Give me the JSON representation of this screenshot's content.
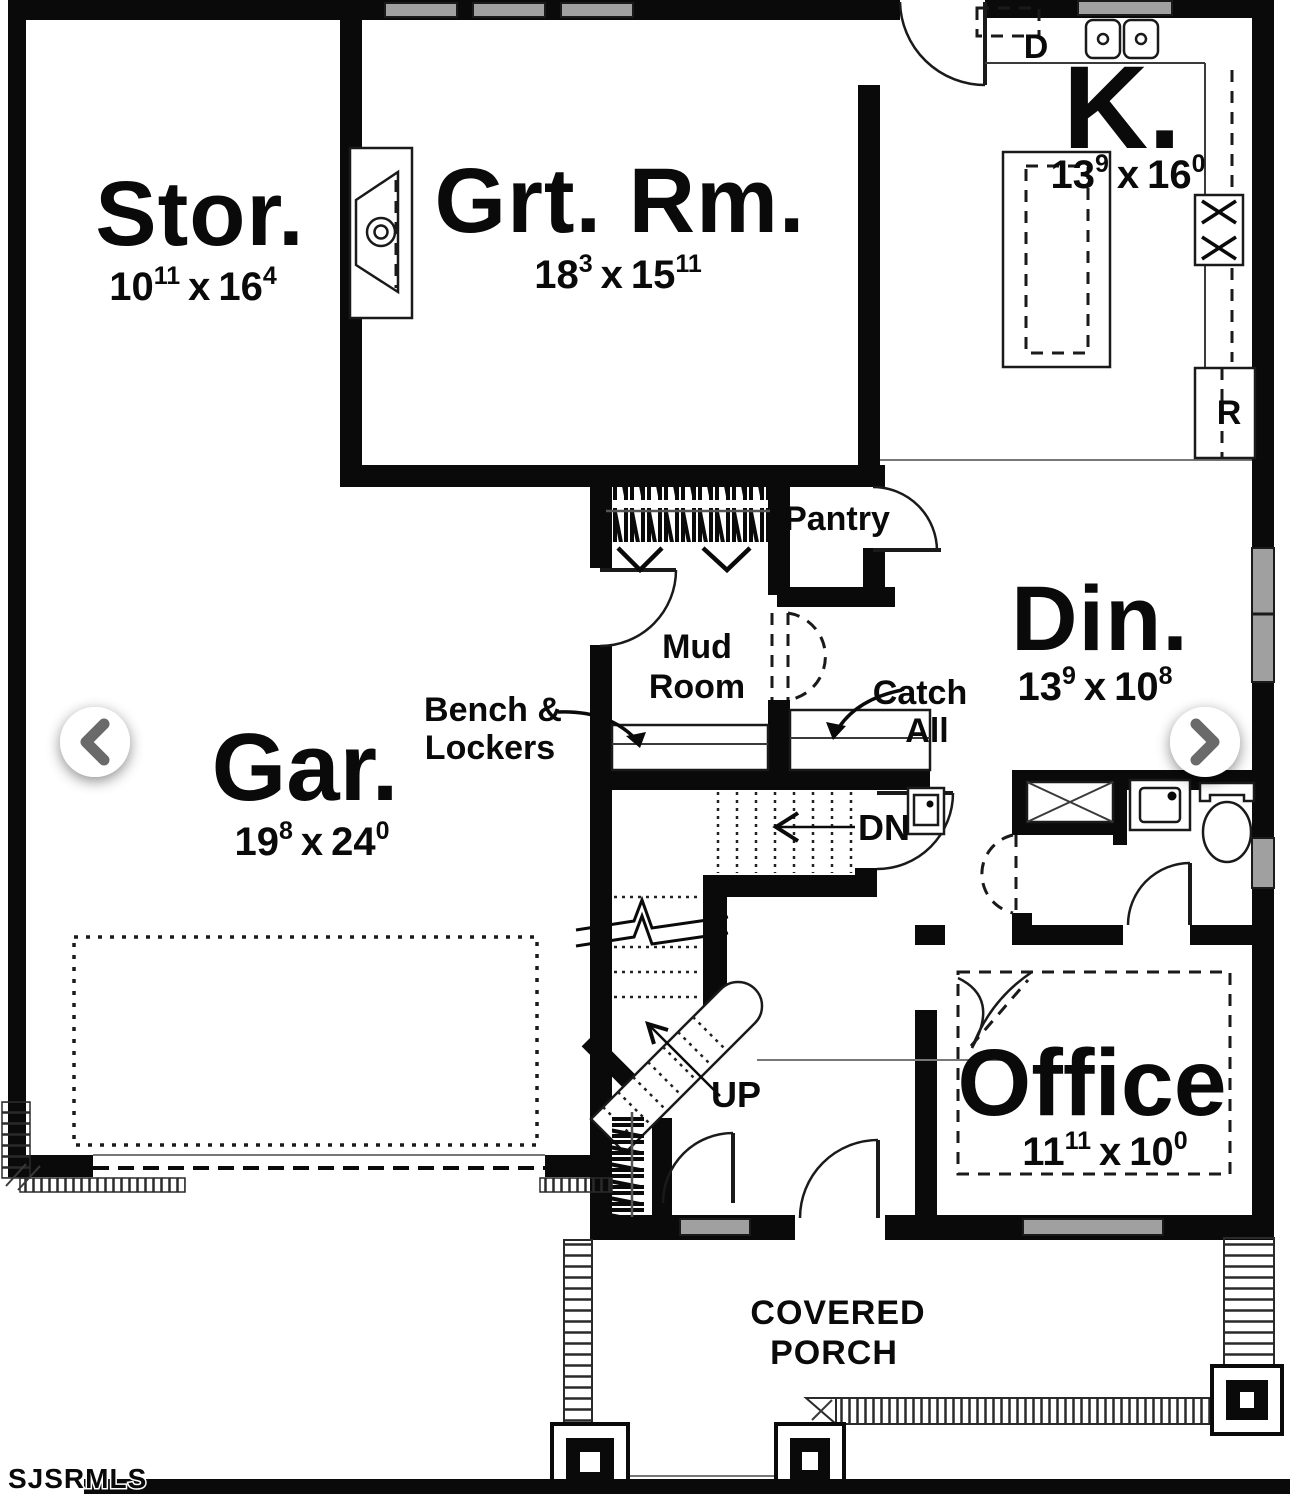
{
  "watermark": "SJSRMLS",
  "colors": {
    "wall": "#0a0a0a",
    "window_fill": "#a0a0a0",
    "arrow_chevron": "#6a6a6a",
    "page_background": "#ffffff"
  },
  "rooms": {
    "storage": {
      "label": "Stor.",
      "dim_a": "10",
      "dim_a_sup": "11",
      "dim_sep": "x",
      "dim_b": "16",
      "dim_b_sup": "4"
    },
    "great_room": {
      "label": "Grt. Rm.",
      "dim_a": "18",
      "dim_a_sup": "3",
      "dim_sep": "x",
      "dim_b": "15",
      "dim_b_sup": "11"
    },
    "kitchen": {
      "label": "K.",
      "dim_a": "13",
      "dim_a_sup": "9",
      "dim_sep": "x",
      "dim_b": "16",
      "dim_b_sup": "0"
    },
    "dining": {
      "label": "Din.",
      "dim_a": "13",
      "dim_a_sup": "9",
      "dim_sep": "x",
      "dim_b": "10",
      "dim_b_sup": "8"
    },
    "garage": {
      "label": "Gar.",
      "dim_a": "19",
      "dim_a_sup": "8",
      "dim_sep": "x",
      "dim_b": "24",
      "dim_b_sup": "0"
    },
    "office": {
      "label": "Office",
      "dim_a": "11",
      "dim_a_sup": "11",
      "dim_sep": "x",
      "dim_b": "10",
      "dim_b_sup": "0"
    },
    "mud_room": {
      "line1": "Mud",
      "line2": "Room"
    },
    "pantry": {
      "label": "Pantry"
    },
    "covered_porch": {
      "line1": "COVERED",
      "line2": "PORCH"
    }
  },
  "annotations": {
    "bench_lockers_line1": "Bench &",
    "bench_lockers_line2": "Lockers",
    "catch_all_line1": "Catch",
    "catch_all_line2": "All",
    "stairs_down": "DN",
    "stairs_up": "UP",
    "dishwasher": "D",
    "refrigerator": "R"
  }
}
